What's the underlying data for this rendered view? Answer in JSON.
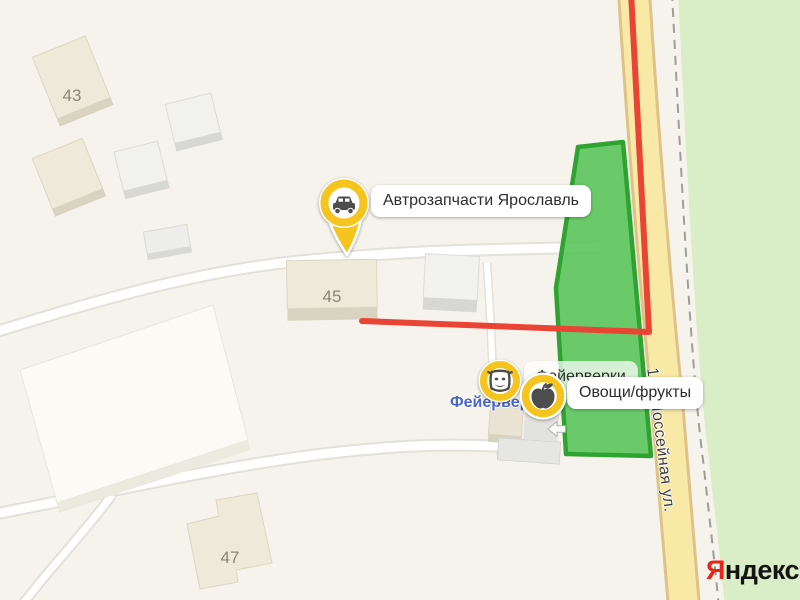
{
  "map_labels": {
    "buildings": [
      {
        "number": "43"
      },
      {
        "number": "45"
      },
      {
        "number": "47"
      }
    ],
    "street_name": "1-я Шоссейная ул.",
    "poi_blue_label": "Фейерверки"
  },
  "pins": {
    "car": {
      "icon": "car-icon",
      "label": "Автрозапчасти Ярославль"
    },
    "mask": {
      "icon": "theater-mask-icon"
    },
    "apple": {
      "icon": "apple-icon",
      "label": "Овощи/фрукты"
    }
  },
  "plaques": {
    "auto_parts": "Автрозапчасти Ярославль",
    "fireworks": "Фейерверки",
    "produce": "Овощи/фрукты"
  },
  "logo": {
    "ya": "Я",
    "rest": "ндекс"
  },
  "colors": {
    "route_red": "#ea4435",
    "parcel_green_fill": "#57c457",
    "parcel_green_border": "#2fa32f",
    "road_yellow": "#f8e9a6",
    "road_yellow_casing": "#dfc287",
    "pin_ring_yellow": "#f5c41f",
    "vegetation_green": "#d9edc6",
    "map_background": "#f5f3ec",
    "logo_red": "#ec2318"
  }
}
